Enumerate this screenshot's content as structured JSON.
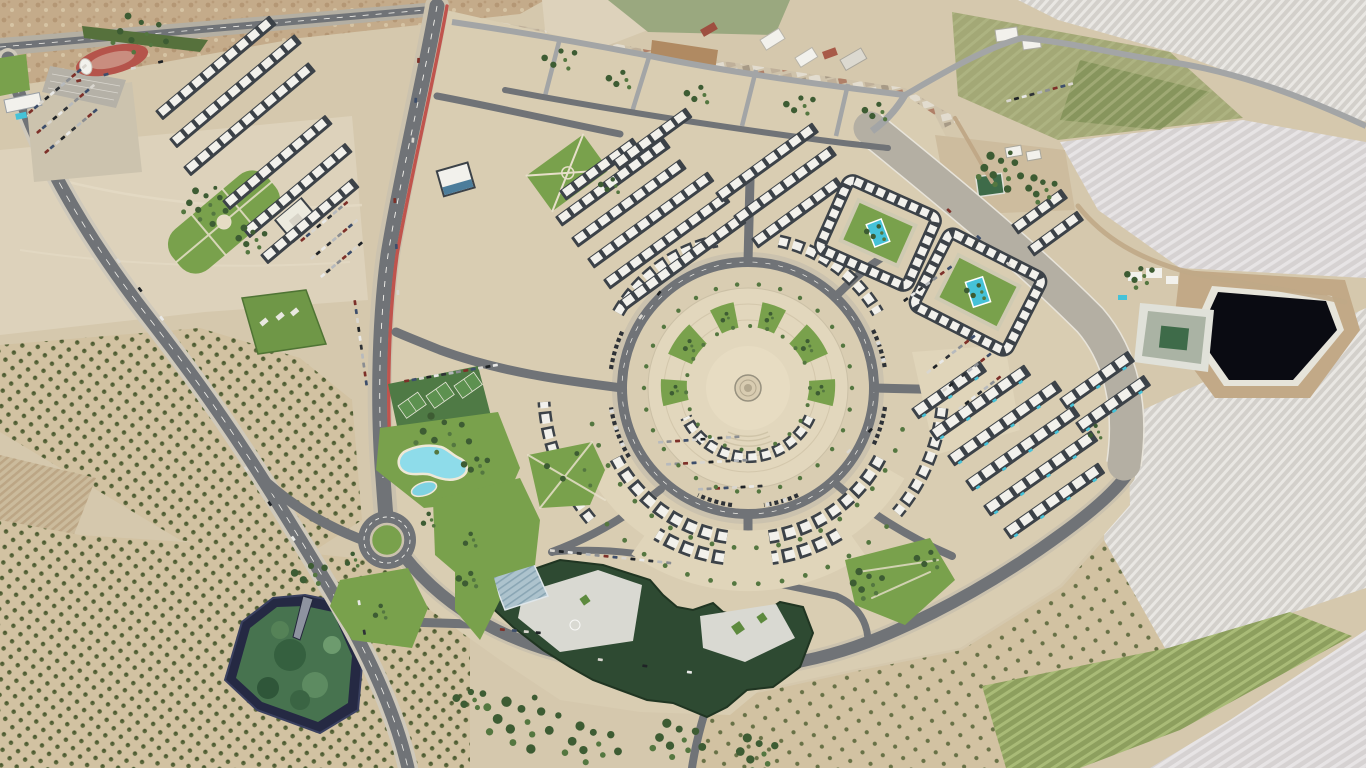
{
  "meta": {
    "title": "Oblique aerial photograph",
    "subject": "Master-planned resort community with circular central plaza, surrounded by olive groves, irrigation reservoirs and striped farmland",
    "visible_text": "none",
    "landmarks": [
      "stadium-running-track",
      "apartment-row-district-northwest",
      "old-village-top-center",
      "central-circular-plaza",
      "plaza-fountain",
      "housing-arcs",
      "courtyard-apartment-blocks-with-pools",
      "villa-district-southeast",
      "school-campus-dark-green-roof",
      "lagoon-pool",
      "tennis-courts",
      "public-park",
      "green-roof-supermarket",
      "main-avenue-with-red-bike-lane",
      "west-highway",
      "main-roundabout",
      "olive-groves-west",
      "irrigation-reservoir-southwest-green-water",
      "irrigation-reservoir-east-black-water",
      "striped-farm-fields-east",
      "farm-compounds"
    ]
  },
  "palette": {
    "sandBase": "#d5c8ad",
    "sandLight": "#ddd2bb",
    "sandPale": "#e3dac4",
    "hill": "#c4ab8a",
    "hillDot": "#b0926f",
    "hillDot2": "#d6c4a4",
    "groveGround": "#d2c2a2",
    "olive": "#5c683c",
    "oliveDark": "#46542e",
    "plate": "#d9cdb2",
    "plaza": "#e2d7bd",
    "plazaIn": "#e7dcc2",
    "fieldPale": "#d3d0cb",
    "fieldPaleStripe": "#e9e7e3",
    "fieldPale2": "#d6d2d2",
    "fieldPale2Stripe": "#e7e4e5",
    "fieldOlive": "#a3a876",
    "fieldOliveDark": "#7d8f55",
    "fieldGreen": "#8d9f5e",
    "fieldGreenStripe": "#a9bb77",
    "plowBase": "#cbbb9c",
    "plowStripe": "#bca685",
    "dirt": "#b08a62",
    "dirtTrack": "#c0a887",
    "asphalt": "#707377",
    "asphaltDark": "#5c5f63",
    "roadLight": "#b4afa3",
    "roadEdge": "#cfc9bb",
    "sidewalk": "#cbc2ae",
    "laneWhite": "#f2f1ec",
    "redLane": "#c0544d",
    "lawn": "#79a14c",
    "lawnDark": "#5d8a3e",
    "lawnPath": "#e7dfca",
    "treeDark": "#3d5c33",
    "treeMid": "#547740",
    "pool": "#45c2d8",
    "poolLight": "#7fd2e2",
    "lagoon": "#8edcea",
    "beach": "#efe8d6",
    "bldgWhite": "#f2f1ec",
    "bldgBase": "#3c4248",
    "bldgGray": "#b5b1a7",
    "campusRoof": "#2e4a32",
    "campusCourt": "#d9d9d2",
    "solar": "#adc3cd",
    "solarLine": "#8aa6b4",
    "greenRoof": "#6f9747",
    "blueRoof": "#4c7d9b",
    "track": "#b5544b",
    "trackIn": "#c98d7f",
    "terrace": "#b5b1a7",
    "resNavy": "#252943",
    "resGreen": "#47734f",
    "resBlack": "#0a0b12",
    "resRim": "#e6e4da",
    "basinRim": "#e0e1d9",
    "basinIn": "#aab3a4",
    "basinGreen": "#3e6b49",
    "villageBase": "#cfc3ab",
    "villageA": "#e2dccf",
    "villageB": "#bfb09a",
    "villageC": "#a79a86",
    "villageRed": "#b08068"
  },
  "generated": {
    "carColors": [
      "#e9e9e7",
      "#2e3236",
      "#b7babd",
      "#8a8d91",
      "#7d3029",
      "#3d4e6b",
      "#d9d6cf",
      "#1f2326"
    ],
    "rows": [
      [
        158,
        110,
        -40,
        10
      ],
      [
        172,
        138,
        -40,
        11
      ],
      [
        186,
        166,
        -40,
        11
      ],
      [
        225,
        200,
        -40,
        9
      ],
      [
        245,
        228,
        -40,
        9
      ],
      [
        263,
        254,
        -40,
        8
      ],
      [
        562,
        190,
        -36,
        6
      ],
      [
        558,
        216,
        -36,
        9
      ],
      [
        574,
        237,
        -36,
        9
      ],
      [
        590,
        258,
        -36,
        10
      ],
      [
        606,
        279,
        -36,
        10
      ],
      [
        622,
        300,
        -36,
        10
      ],
      [
        615,
        160,
        -36,
        6
      ],
      [
        718,
        192,
        -36,
        8
      ],
      [
        736,
        215,
        -36,
        8
      ],
      [
        754,
        238,
        -36,
        7
      ],
      [
        1014,
        224,
        -36,
        4
      ],
      [
        1030,
        246,
        -36,
        4
      ],
      [
        914,
        408,
        -35,
        5,
        16,
        11.5,
        9,
        1
      ],
      [
        932,
        430,
        -35,
        7,
        16,
        11.5,
        9,
        1
      ],
      [
        950,
        455,
        -35,
        8,
        16,
        11.5,
        9,
        1
      ],
      [
        968,
        480,
        -35,
        8,
        16,
        11.5,
        9,
        1
      ],
      [
        986,
        505,
        -35,
        8,
        16,
        11.5,
        9,
        1
      ],
      [
        1006,
        528,
        -35,
        7,
        16,
        11.5,
        9,
        1
      ],
      [
        1062,
        398,
        -35,
        5,
        16,
        11.5,
        9,
        1
      ],
      [
        1078,
        422,
        -35,
        5,
        16,
        11.5,
        9,
        1
      ]
    ],
    "carRows": [
      [
        28,
        112,
        -40,
        11,
        7
      ],
      [
        36,
        132,
        -40,
        11,
        7
      ],
      [
        44,
        152,
        -40,
        10,
        7
      ],
      [
        300,
        240,
        -40,
        9,
        7
      ],
      [
        310,
        258,
        -40,
        9,
        7
      ],
      [
        320,
        276,
        -40,
        8,
        7
      ],
      [
        404,
        380,
        -10,
        13,
        7.5
      ],
      [
        356,
        300,
        82,
        10,
        9
      ],
      [
        550,
        549,
        6,
        14,
        9
      ],
      [
        658,
        441,
        -4,
        10,
        8.5
      ],
      [
        666,
        463,
        -3,
        10,
        8.5
      ],
      [
        698,
        488,
        -3,
        8,
        8.5
      ],
      [
        926,
        372,
        -38,
        8,
        8
      ],
      [
        942,
        390,
        -38,
        8,
        8
      ],
      [
        958,
        408,
        -38,
        7,
        8
      ],
      [
        1006,
        100,
        -15,
        9,
        8
      ],
      [
        903,
        300,
        -36,
        7,
        9
      ],
      [
        118,
        258,
        53,
        3,
        36
      ],
      [
        246,
        466,
        56,
        3,
        42
      ],
      [
        360,
        600,
        80,
        2,
        30
      ],
      [
        420,
        58,
        94,
        3,
        40
      ],
      [
        396,
        198,
        88,
        3,
        46
      ],
      [
        948,
        208,
        42,
        3,
        40
      ],
      [
        598,
        658,
        8,
        3,
        45
      ],
      [
        76,
        80,
        -13,
        4,
        28
      ],
      [
        638,
        318,
        -52,
        2,
        30
      ],
      [
        846,
        452,
        -44,
        2,
        30
      ],
      [
        500,
        628,
        5,
        4,
        12
      ]
    ],
    "treeClusters": [
      [
        205,
        205,
        12,
        26,
        3
      ],
      [
        252,
        240,
        8,
        18,
        3
      ],
      [
        443,
        434,
        10,
        30,
        3.2
      ],
      [
        476,
        466,
        6,
        14,
        3
      ],
      [
        470,
        580,
        5,
        12,
        3
      ],
      [
        868,
        585,
        8,
        20,
        3.2
      ],
      [
        930,
        560,
        5,
        14,
        3
      ],
      [
        560,
        60,
        6,
        18,
        3
      ],
      [
        622,
        80,
        5,
        14,
        3
      ],
      [
        700,
        95,
        5,
        14,
        3
      ],
      [
        800,
        106,
        6,
        16,
        3
      ],
      [
        878,
        112,
        5,
        14,
        3
      ],
      [
        1000,
        170,
        12,
        26,
        3.6
      ],
      [
        1042,
        190,
        8,
        18,
        3.2
      ],
      [
        1140,
        276,
        7,
        16,
        3
      ],
      [
        520,
        722,
        14,
        40,
        4.5
      ],
      [
        592,
        744,
        10,
        30,
        4
      ],
      [
        678,
        740,
        10,
        28,
        4
      ],
      [
        758,
        754,
        8,
        24,
        4
      ],
      [
        470,
        700,
        6,
        16,
        3.6
      ],
      [
        352,
        560,
        4,
        10,
        2.6
      ],
      [
        428,
        520,
        4,
        10,
        2.6
      ],
      [
        310,
        575,
        6,
        18,
        3.5
      ],
      [
        140,
        34,
        10,
        30,
        3
      ],
      [
        878,
        233,
        5,
        12,
        2.6
      ],
      [
        978,
        292,
        5,
        12,
        2.6
      ],
      [
        470,
        540,
        4,
        10,
        2.6
      ],
      [
        380,
        612,
        4,
        10,
        2.6
      ],
      [
        1095,
        432,
        4,
        10,
        2.4
      ],
      [
        612,
        186,
        5,
        12,
        2.6
      ],
      [
        575,
        470,
        5,
        30,
        2.8
      ],
      [
        689,
        346,
        4,
        8,
        2.4
      ],
      [
        726,
        318,
        3,
        6,
        2.2
      ],
      [
        770,
        318,
        3,
        6,
        2.2
      ],
      [
        807,
        346,
        4,
        8,
        2.4
      ],
      [
        675,
        391,
        3,
        6,
        2.2
      ],
      [
        821,
        391,
        3,
        6,
        2.2
      ]
    ],
    "palmRings": [
      {
        "cx": 748,
        "cy": 388,
        "r": 104,
        "step": 12,
        "s": 2.2
      },
      {
        "cx": 748,
        "cy": 388,
        "r": 160,
        "step": 8,
        "s": 2.4,
        "a1": 15,
        "a2": 168
      },
      {
        "cx": 748,
        "cy": 388,
        "r": 62,
        "step": 16,
        "s": 2
      },
      {
        "cx": 748,
        "cy": 388,
        "r": 196,
        "step": 7,
        "s": 2.4,
        "a1": 45,
        "a2": 140
      }
    ]
  }
}
